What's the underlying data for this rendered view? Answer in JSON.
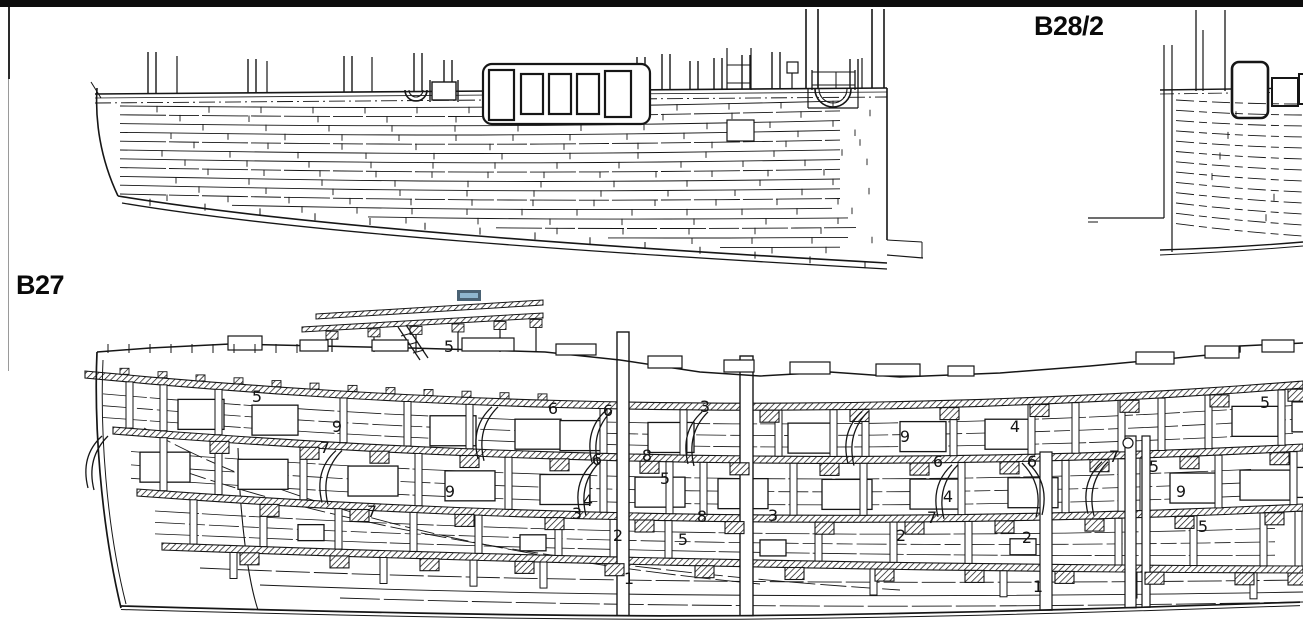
{
  "page": {
    "background": "#ffffff",
    "top_bar_color": "#0d0d0d"
  },
  "drawings": {
    "top": {
      "code": "B28/2"
    },
    "bottom": {
      "code": "B27"
    }
  },
  "selection_marker": {
    "fill": "#8fb6cf",
    "border": "#4a6274"
  },
  "part_labels": [
    {
      "label": "5",
      "x": 449,
      "y": 348
    },
    {
      "label": "5",
      "x": 257,
      "y": 398
    },
    {
      "label": "9",
      "x": 337,
      "y": 428
    },
    {
      "label": "7",
      "x": 325,
      "y": 449
    },
    {
      "label": "6",
      "x": 553,
      "y": 410
    },
    {
      "label": "6",
      "x": 608,
      "y": 412
    },
    {
      "label": "3",
      "x": 705,
      "y": 408
    },
    {
      "label": "9",
      "x": 905,
      "y": 438
    },
    {
      "label": "4",
      "x": 1015,
      "y": 428
    },
    {
      "label": "6",
      "x": 597,
      "y": 461
    },
    {
      "label": "8",
      "x": 647,
      "y": 457
    },
    {
      "label": "6",
      "x": 938,
      "y": 463
    },
    {
      "label": "6",
      "x": 1032,
      "y": 463
    },
    {
      "label": "7",
      "x": 1114,
      "y": 458
    },
    {
      "label": "5",
      "x": 1154,
      "y": 468
    },
    {
      "label": "5",
      "x": 665,
      "y": 480
    },
    {
      "label": "9",
      "x": 450,
      "y": 493
    },
    {
      "label": "4",
      "x": 588,
      "y": 502
    },
    {
      "label": "4",
      "x": 948,
      "y": 498
    },
    {
      "label": "9",
      "x": 1181,
      "y": 493
    },
    {
      "label": "3",
      "x": 577,
      "y": 515
    },
    {
      "label": "8",
      "x": 702,
      "y": 518
    },
    {
      "label": "2",
      "x": 618,
      "y": 537
    },
    {
      "label": "5",
      "x": 683,
      "y": 541
    },
    {
      "label": "7",
      "x": 932,
      "y": 519
    },
    {
      "label": "3",
      "x": 773,
      "y": 517
    },
    {
      "label": "2",
      "x": 901,
      "y": 537
    },
    {
      "label": "2",
      "x": 1027,
      "y": 539
    },
    {
      "label": "5",
      "x": 1203,
      "y": 528
    },
    {
      "label": "5",
      "x": 1265,
      "y": 404
    },
    {
      "label": "7",
      "x": 372,
      "y": 513
    },
    {
      "label": "1",
      "x": 629,
      "y": 580
    },
    {
      "label": "1",
      "x": 1038,
      "y": 588
    }
  ]
}
